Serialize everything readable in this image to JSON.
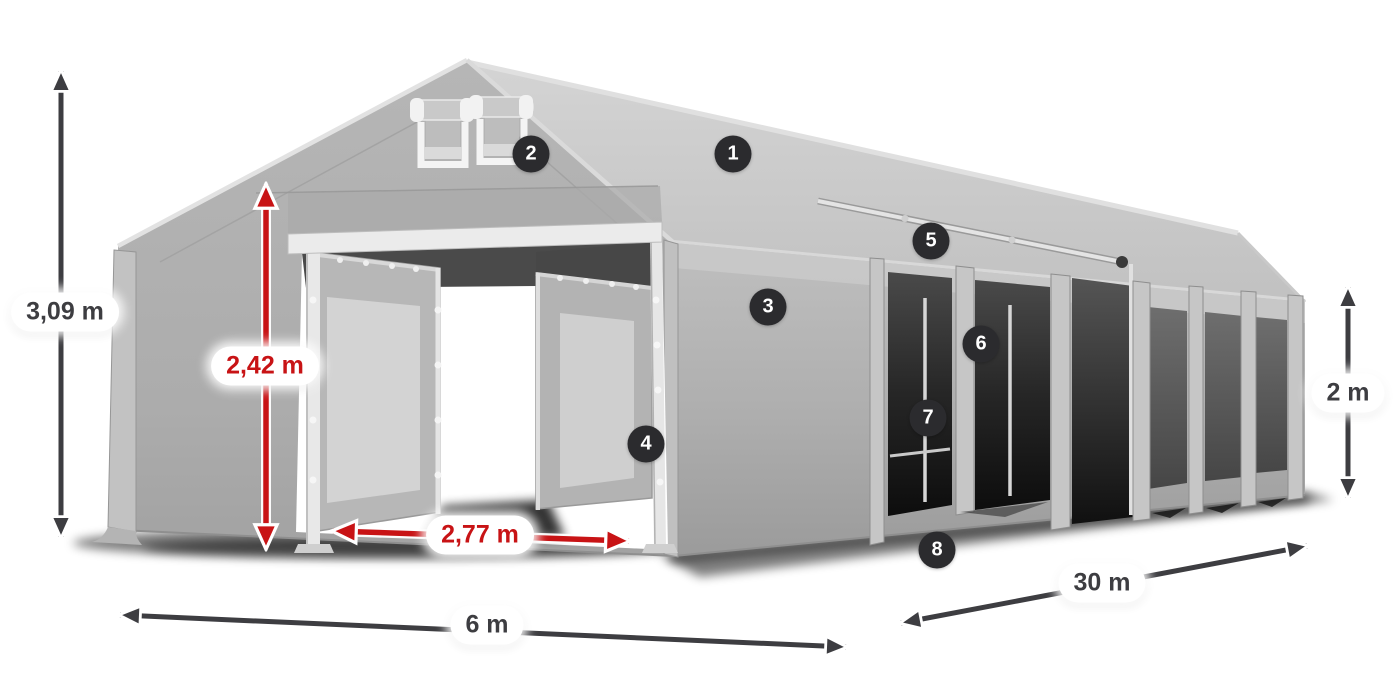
{
  "diagram": {
    "title": "Marquee tent dimension diagram",
    "dimension_labels": {
      "total_height": "3,09 m",
      "entrance_height": "2,42 m",
      "entrance_width": "2,77 m",
      "tent_width": "6 m",
      "tent_length": "30 m",
      "side_wall_height": "2 m"
    },
    "feature_markers": [
      "1",
      "2",
      "3",
      "4",
      "5",
      "6",
      "7",
      "8"
    ],
    "colors": {
      "background": "#ffffff",
      "dimension_arrow_dark": "#3d3d41",
      "dimension_arrow_red": "#c81315",
      "label_background": "#ffffff",
      "label_text_dark": "#3d3d41",
      "label_text_red": "#c81315",
      "marker_background": "#2b2b2e",
      "marker_text": "#ffffff",
      "tent_roof": "#cccccc",
      "tent_gable": "#afafaf",
      "tent_wall": "#b0b0b0",
      "tent_window": "#565656",
      "tent_frame": "#e8e8e8"
    }
  }
}
